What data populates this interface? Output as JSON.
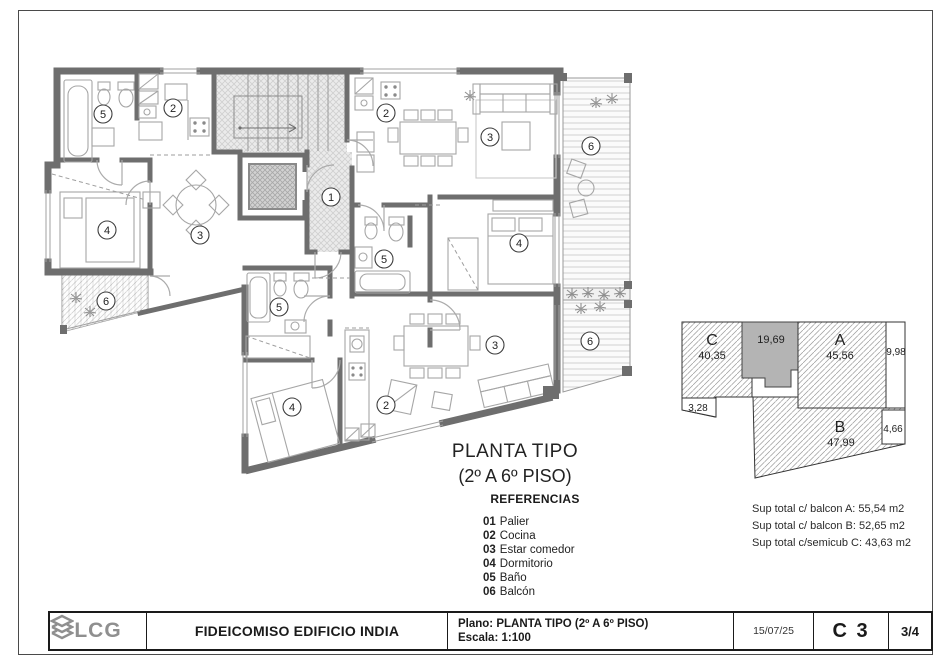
{
  "plan": {
    "title_line1": "PLANTA TIPO",
    "title_line2": "(2º A 6º PISO)",
    "room_labels": [
      "5",
      "2",
      "3",
      "4",
      "6",
      "1",
      "2",
      "3",
      "4",
      "5",
      "6",
      "5",
      "4",
      "2",
      "3",
      "6"
    ]
  },
  "references": {
    "heading": "REFERENCIAS",
    "items": [
      {
        "num": "01",
        "label": "Palier"
      },
      {
        "num": "02",
        "label": "Cocina"
      },
      {
        "num": "03",
        "label": "Estar comedor"
      },
      {
        "num": "04",
        "label": "Dormitorio"
      },
      {
        "num": "05",
        "label": "Baño"
      },
      {
        "num": "06",
        "label": "Balcón"
      }
    ]
  },
  "keyplan": {
    "unit_c": "C",
    "unit_c_area": "40,35",
    "common_area": "19,69",
    "unit_a": "A",
    "unit_a_area": "45,56",
    "side_right": "9,98",
    "side_left": "3,28",
    "side_b": "4,66",
    "unit_b": "B",
    "unit_b_area": "47,99",
    "hatch_color": "#9a9a9a",
    "common_fill": "#b4b4b4"
  },
  "totals": {
    "line_a": "Sup total c/ balcon A:  55,54 m2",
    "line_b": "Sup total c/ balcon B:  52,65 m2",
    "line_c": "Sup total c/semicub C:  43,63 m2"
  },
  "title_block": {
    "logo_text": "LCG",
    "project": "FIDEICOMISO EDIFICIO INDIA",
    "plano_line": "Plano: PLANTA TIPO (2º A 6º PISO)",
    "escala_line": "Escala: 1:100",
    "date": "15/07/25",
    "sheet_code": "C 3",
    "page": "3/4"
  }
}
